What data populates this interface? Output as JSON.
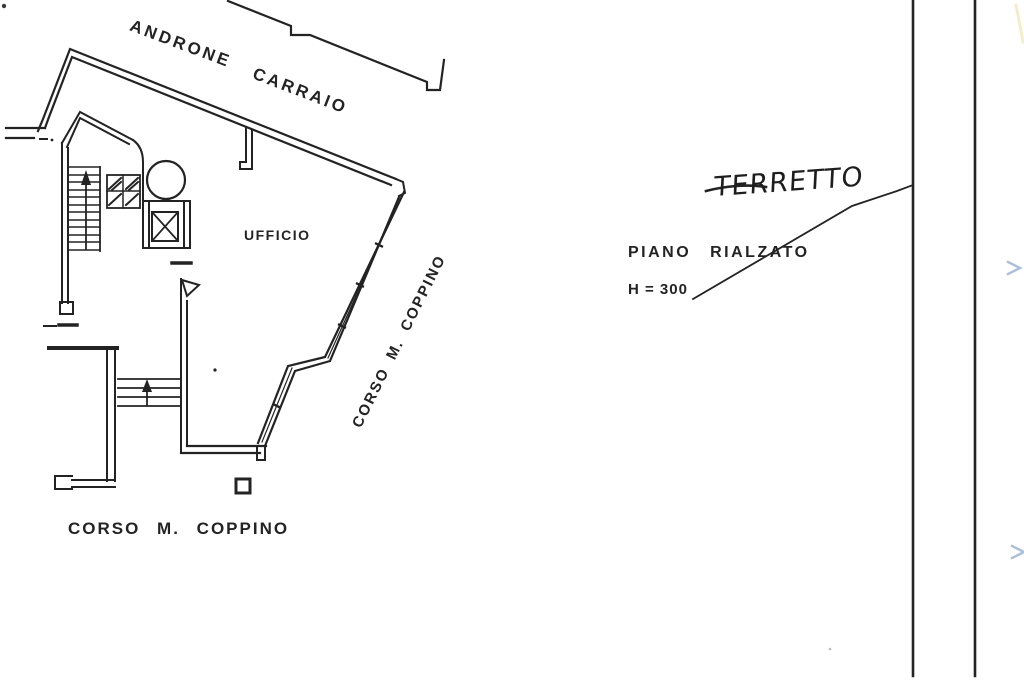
{
  "colors": {
    "paper": "#ffffff",
    "ink": "#232323",
    "artifact_blue": "#7d9fc4",
    "artifact_yellow": "#e8e0a0"
  },
  "labels": {
    "androne": "ANDRONE",
    "carraio": "CARRAIO",
    "ufficio": "UFFICIO",
    "corso_coppino_diagonal": "CORSO M. COPPINO",
    "corso_coppino_bottom": "CORSO M. COPPINO",
    "piano_rialzato": "PIANO RIALZATO",
    "height_note": "H = 300",
    "handwritten_note": "TERRETTO"
  },
  "plan": {
    "drawing_type": "scanned floor plan",
    "rooms": [
      {
        "label": "UFFICIO"
      }
    ],
    "common_areas": [
      {
        "label": "ANDRONE CARRAIO"
      }
    ],
    "streets": [
      {
        "label": "CORSO M. COPPINO",
        "orientation": "diagonal-facade"
      },
      {
        "label": "CORSO M. COPPINO",
        "orientation": "horizontal-bottom"
      }
    ],
    "annotations": [
      {
        "label": "PIANO RIALZATO",
        "style": "printed"
      },
      {
        "label": "H = 300",
        "style": "printed"
      },
      {
        "label": "TERRETTO",
        "style": "handwritten",
        "note": "leader line points to right boundary wall"
      }
    ],
    "symbols": [
      "main-staircase-up-arrow",
      "entrance-steps-up-arrow",
      "elevator-shaft-x-box",
      "column-circle",
      "door-pennant",
      "right-boundary-double-wall"
    ]
  }
}
